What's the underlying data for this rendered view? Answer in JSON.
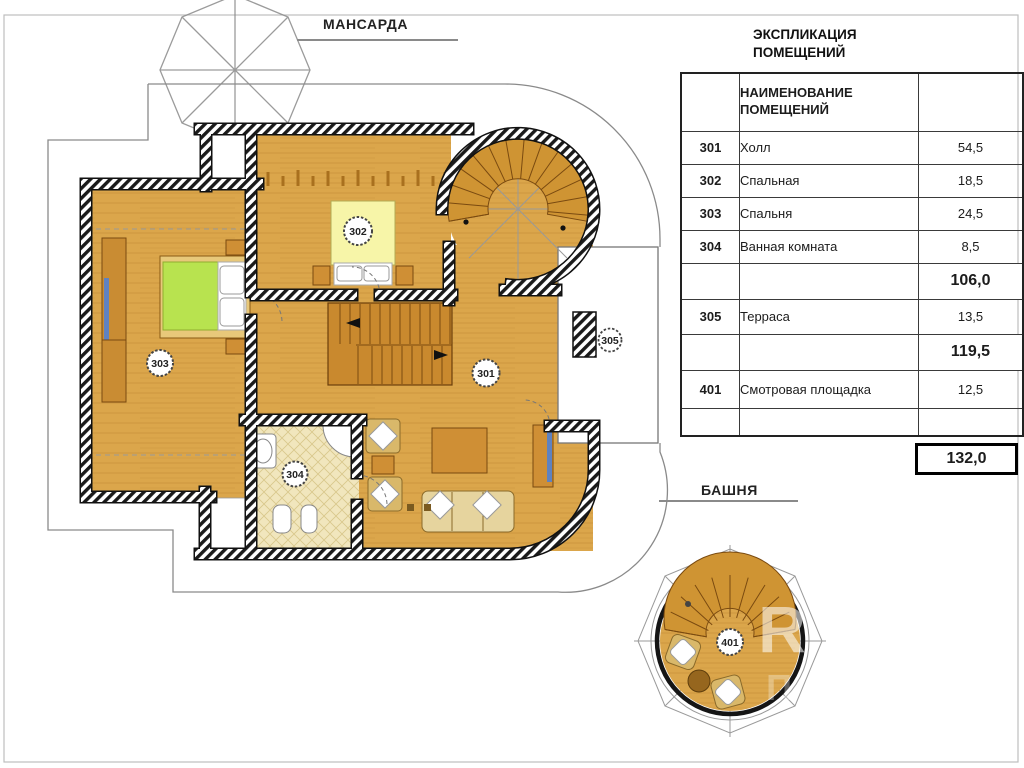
{
  "plan": {
    "mansarda_title": "МАНСАРДА",
    "bashnya_title": "БАШНЯ",
    "rooms": {
      "r301": "301",
      "r302": "302",
      "r303": "303",
      "r304": "304",
      "r305": "305",
      "r401": "401"
    }
  },
  "legend": {
    "title1": "ЭКСПЛИКАЦИЯ",
    "title2": "ПОМЕЩЕНИЙ",
    "col_header1": "НАИМЕНОВАНИЕ",
    "col_header2": "ПОМЕЩЕНИЙ",
    "rows": [
      {
        "num": "301",
        "name": "Холл",
        "area": "54,5"
      },
      {
        "num": "302",
        "name": "Спальная",
        "area": "18,5"
      },
      {
        "num": "303",
        "name": "Спальня",
        "area": "24,5"
      },
      {
        "num": "304",
        "name": "Ванная комната",
        "area": "8,5"
      },
      {
        "num": "305",
        "name": "Терраса",
        "area": "13,5"
      },
      {
        "num": "401",
        "name": "Смотровая площадка",
        "area": "12,5"
      }
    ],
    "subtotal_first": "106,0",
    "subtotal_second": "119,5",
    "total": "132,0"
  },
  "watermark": {
    "letter1": "R",
    "letter2": "П"
  },
  "colors": {
    "floor": "#dba64b",
    "wall": "#1a1a1a",
    "bed_green": "#b8e34f",
    "bed_yellow": "#f7f5a8",
    "accent_blue": "#5f82c0",
    "stair": "#c9892e"
  }
}
